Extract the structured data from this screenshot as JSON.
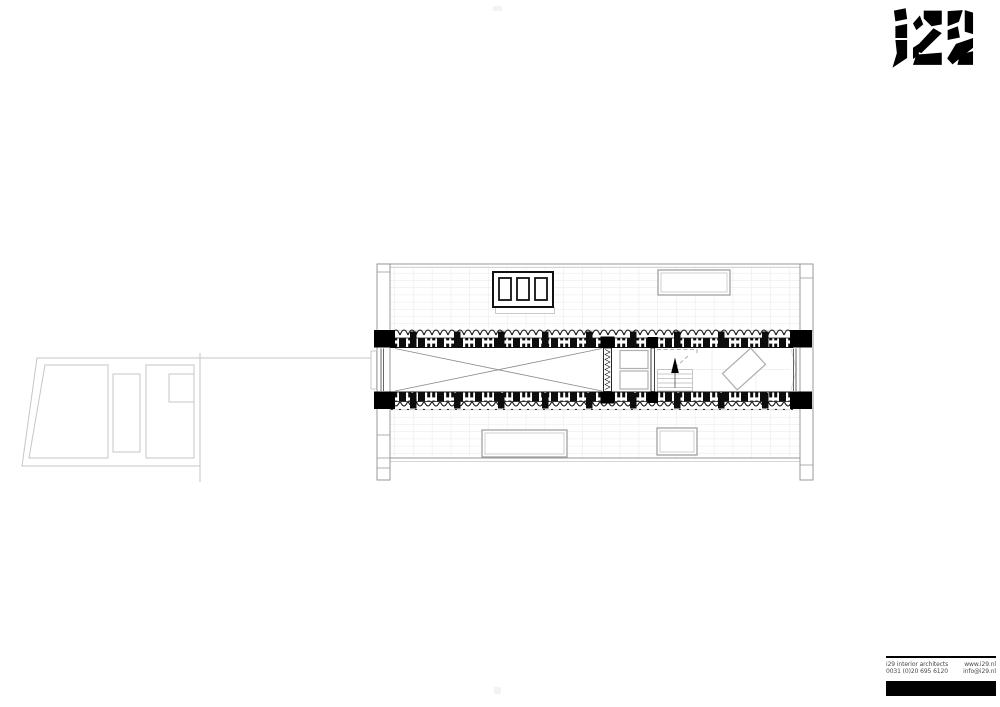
{
  "logo": {
    "text": "i29"
  },
  "footer": {
    "rows": [
      {
        "left": "i29 interior architects",
        "right": "www.i29.nl"
      },
      {
        "left": "0031 (0)20 695 6120",
        "right": "info@i29.nl"
      }
    ]
  },
  "plan": {
    "drawing": "roof-level floor plan with section bands",
    "elements": {
      "dormer_window_panes": 3,
      "skylights": 3,
      "stair_direction": "up",
      "void_marker": "x-cross",
      "annex": "garden-level outbuilding outline"
    }
  },
  "colors": {
    "ink": "#111111",
    "black": "#000000",
    "line_mid": "#8f8f8f",
    "line_light": "#c6c6c6",
    "grid_faint": "#ebebeb",
    "text_gray": "#4a4a4a",
    "paper": "#ffffff"
  }
}
